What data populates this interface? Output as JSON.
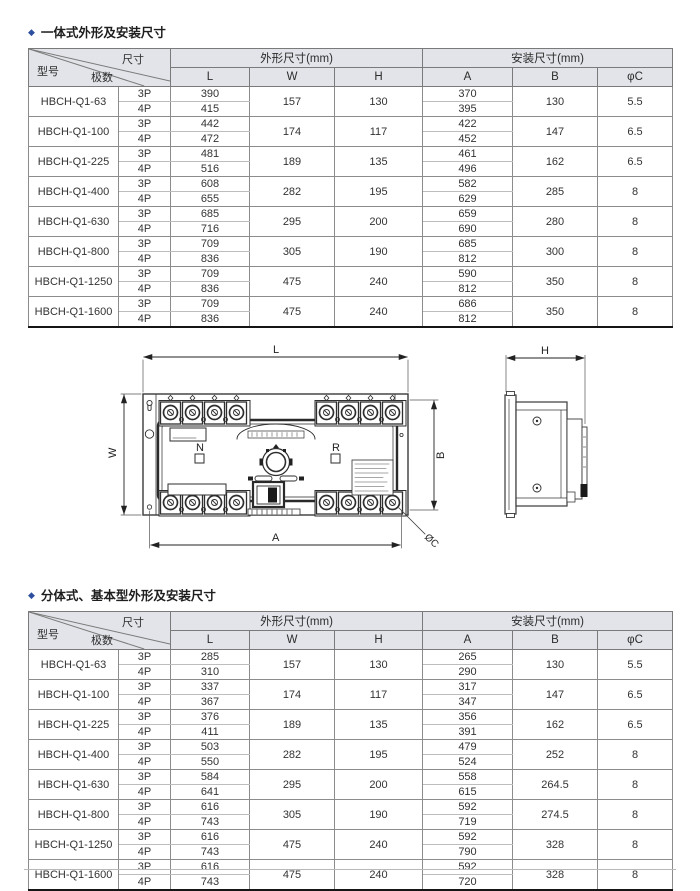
{
  "page": {
    "bullet": "◆",
    "section1_title": "一体式外形及安装尺寸",
    "section2_title": "分体式、基本型外形及安装尺寸",
    "accent_color": "#2d4f9e",
    "header_bg": "#e2e4e9"
  },
  "table_headers": {
    "model": "型号",
    "poles": "极数",
    "size": "尺寸",
    "outline_group": "外形尺寸(mm)",
    "install_group": "安装尺寸(mm)",
    "cols": [
      "L",
      "W",
      "H",
      "A",
      "B",
      "φC"
    ],
    "poles_3p": "3P",
    "poles_4p": "4P"
  },
  "table1": {
    "rows": [
      {
        "model": "HBCH-Q1-63",
        "L3": "390",
        "L4": "415",
        "W": "157",
        "H": "130",
        "A3": "370",
        "A4": "395",
        "B": "130",
        "C": "5.5"
      },
      {
        "model": "HBCH-Q1-100",
        "L3": "442",
        "L4": "472",
        "W": "174",
        "H": "117",
        "A3": "422",
        "A4": "452",
        "B": "147",
        "C": "6.5"
      },
      {
        "model": "HBCH-Q1-225",
        "L3": "481",
        "L4": "516",
        "W": "189",
        "H": "135",
        "A3": "461",
        "A4": "496",
        "B": "162",
        "C": "6.5"
      },
      {
        "model": "HBCH-Q1-400",
        "L3": "608",
        "L4": "655",
        "W": "282",
        "H": "195",
        "A3": "582",
        "A4": "629",
        "B": "285",
        "C": "8"
      },
      {
        "model": "HBCH-Q1-630",
        "L3": "685",
        "L4": "716",
        "W": "295",
        "H": "200",
        "A3": "659",
        "A4": "690",
        "B": "280",
        "C": "8"
      },
      {
        "model": "HBCH-Q1-800",
        "L3": "709",
        "L4": "836",
        "W": "305",
        "H": "190",
        "A3": "685",
        "A4": "812",
        "B": "300",
        "C": "8"
      },
      {
        "model": "HBCH-Q1-1250",
        "L3": "709",
        "L4": "836",
        "W": "475",
        "H": "240",
        "A3": "590",
        "A4": "812",
        "B": "350",
        "C": "8"
      },
      {
        "model": "HBCH-Q1-1600",
        "L3": "709",
        "L4": "836",
        "W": "475",
        "H": "240",
        "A3": "686",
        "A4": "812",
        "B": "350",
        "C": "8"
      }
    ]
  },
  "table2": {
    "rows": [
      {
        "model": "HBCH-Q1-63",
        "L3": "285",
        "L4": "310",
        "W": "157",
        "H": "130",
        "A3": "265",
        "A4": "290",
        "B": "130",
        "C": "5.5"
      },
      {
        "model": "HBCH-Q1-100",
        "L3": "337",
        "L4": "367",
        "W": "174",
        "H": "117",
        "A3": "317",
        "A4": "347",
        "B": "147",
        "C": "6.5"
      },
      {
        "model": "HBCH-Q1-225",
        "L3": "376",
        "L4": "411",
        "W": "189",
        "H": "135",
        "A3": "356",
        "A4": "391",
        "B": "162",
        "C": "6.5"
      },
      {
        "model": "HBCH-Q1-400",
        "L3": "503",
        "L4": "550",
        "W": "282",
        "H": "195",
        "A3": "479",
        "A4": "524",
        "B": "252",
        "C": "8"
      },
      {
        "model": "HBCH-Q1-630",
        "L3": "584",
        "L4": "641",
        "W": "295",
        "H": "200",
        "A3": "558",
        "A4": "615",
        "B": "264.5",
        "C": "8"
      },
      {
        "model": "HBCH-Q1-800",
        "L3": "616",
        "L4": "743",
        "W": "305",
        "H": "190",
        "A3": "592",
        "A4": "719",
        "B": "274.5",
        "C": "8"
      },
      {
        "model": "HBCH-Q1-1250",
        "L3": "616",
        "L4": "743",
        "W": "475",
        "H": "240",
        "A3": "592",
        "A4": "790",
        "B": "328",
        "C": "8"
      },
      {
        "model": "HBCH-Q1-1600",
        "L3": "616",
        "L4": "743",
        "W": "475",
        "H": "240",
        "A3": "592",
        "A4": "720",
        "B": "328",
        "C": "8"
      }
    ]
  },
  "drawing": {
    "labels": {
      "L": "L",
      "W": "W",
      "H": "H",
      "A": "A",
      "B": "B",
      "phiC": "ØC",
      "N": "N",
      "R": "R"
    }
  }
}
